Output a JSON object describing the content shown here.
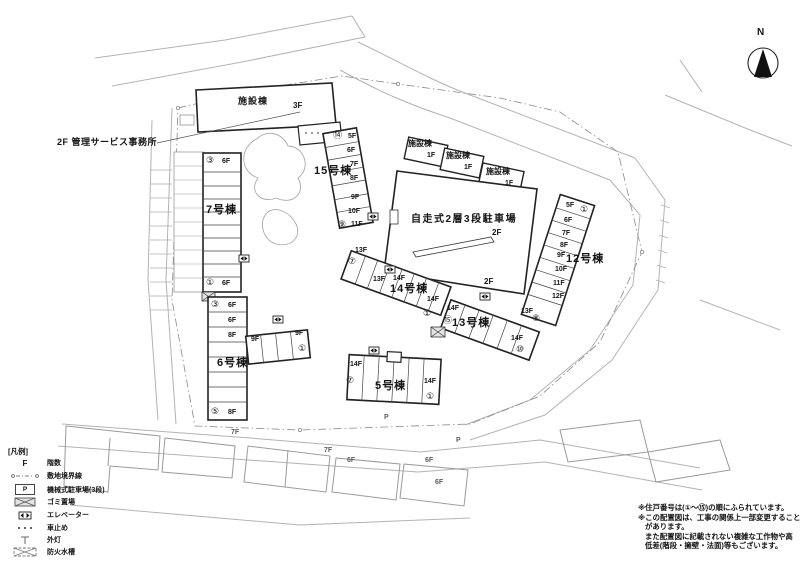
{
  "compass": {
    "label": "N"
  },
  "annotations": {
    "office": "2F 管理サービス事務所",
    "p_road_1": "P",
    "p_road_2": "P"
  },
  "facility_top": {
    "name": "施設棟",
    "floor": "3F"
  },
  "facility_row": [
    {
      "name": "施設棟",
      "floor": "1F"
    },
    {
      "name": "施設棟",
      "floor": "1F"
    },
    {
      "name": "施設棟",
      "floor": "1F"
    }
  ],
  "parking_structure": {
    "name": "自走式2層3段駐車場",
    "floor": "2F",
    "floor2": "2F"
  },
  "bldg7": {
    "name": "7号棟",
    "top_no": "③",
    "top_floor": "6F",
    "bottom_no": "①",
    "bottom_floor": "6F"
  },
  "bldg15": {
    "name": "15号棟",
    "top_no": "⑭",
    "bottom_no": "⑨",
    "floors": [
      "5F",
      "6F",
      "7F",
      "8F",
      "9F",
      "10F",
      "11F"
    ]
  },
  "bldg14": {
    "name": "14号棟",
    "left_floor": "13F",
    "left_no": "⑦",
    "mid_floor_a": "13F",
    "mid_floor_b": "14F",
    "right_floor": "14F",
    "right_no": "①"
  },
  "bldg13": {
    "name": "13号棟",
    "left_floor": "14F",
    "left_no": "⑮",
    "right_floor": "14F",
    "right_no": "⑩"
  },
  "bldg12": {
    "name": "12号棟",
    "top_no": "①",
    "bottom_no": "⑧",
    "floors": [
      "5F",
      "6F",
      "7F",
      "8F",
      "9F",
      "10F",
      "11F",
      "12F",
      "13F"
    ]
  },
  "bldg6": {
    "name": "6号棟",
    "top_no": "③",
    "top_floor": "6F",
    "floor2": "6F",
    "floor3": "8F",
    "bottom_no": "⑤",
    "bottom_floor": "8F",
    "wing_floor_a": "9F",
    "wing_floor_b": "9F",
    "wing_no": "①"
  },
  "bldg5": {
    "name": "5号棟",
    "left_floor": "14F",
    "left_no": "⑦",
    "right_floor": "14F",
    "right_no": "①"
  },
  "neighbors": {
    "f1": "7F",
    "f2": "7F",
    "f3": "6F",
    "f4": "6F",
    "f5": "6F"
  },
  "legend": {
    "title": "[凡例]",
    "floor_symbol": "F",
    "p_symbol": "P",
    "items": [
      {
        "label": "階数"
      },
      {
        "label": "敷地境界線"
      },
      {
        "label": "機械式駐車場(3段)"
      },
      {
        "label": "ゴミ置場"
      },
      {
        "label": "エレベーター"
      },
      {
        "label": "車止め"
      },
      {
        "label": "外灯"
      },
      {
        "label": "防火水槽"
      }
    ]
  },
  "notes": {
    "line1": "※住戸番号は(①～⑮)の順にふられています。",
    "line2": "※この配置図は、工事の関係上一部変更すること",
    "line3": "があります。",
    "line4": "また配置図に記載されない複雑な工作物や高",
    "line5": "低差(階段・擁壁・法面)等もございます。"
  }
}
